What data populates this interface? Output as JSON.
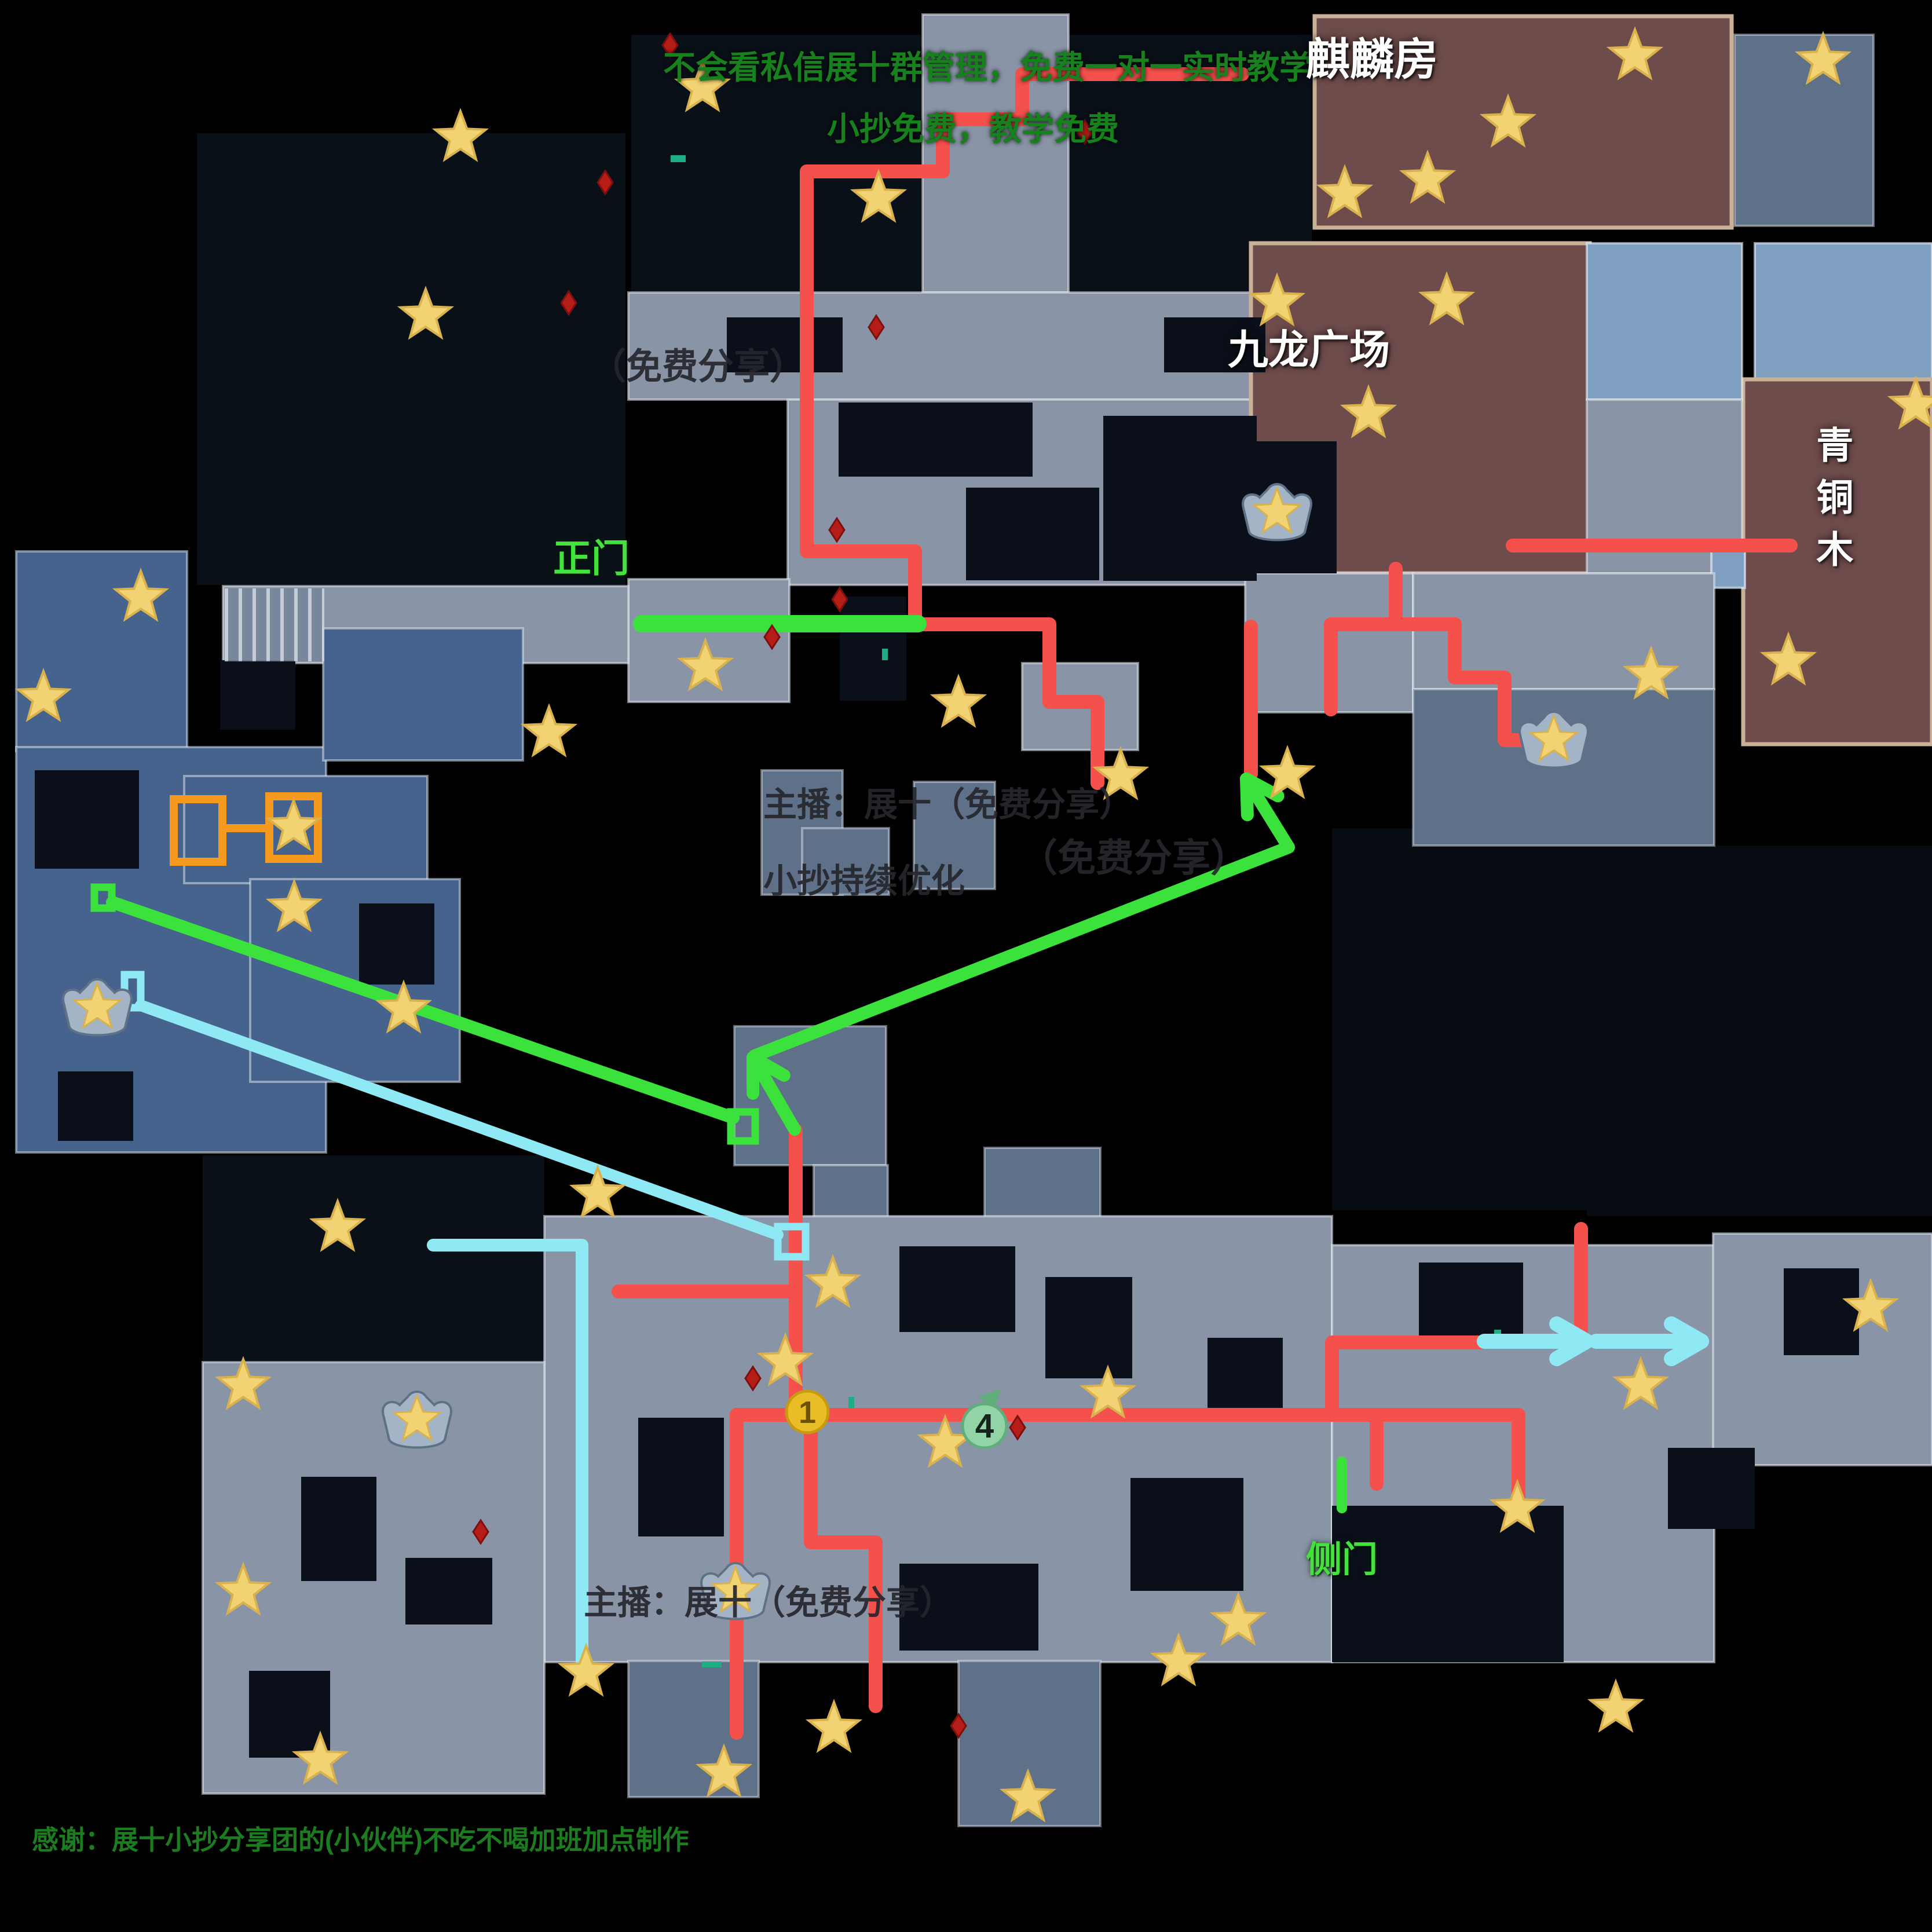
{
  "annotations": {
    "top_line1": "不会看私信展十群管理，免费一对一实时教学",
    "top_line2": "小抄免费，教学免费",
    "wm_share_top": "（免费分享）",
    "wm_host_mid": "主播：展十（免费分享）",
    "wm_optimize": "小抄持续优化",
    "wm_share_right": "（免费分享）",
    "wm_host_bottom": "主播：展十（免费分享）",
    "credit": "感谢：展十小抄分享团的(小伙伴)不吃不喝加班加点制作"
  },
  "labels": {
    "qilin_room": "麒麟房",
    "kowloon_plaza": "九龙广场",
    "bronze_wood": "青铜木",
    "main_gate": "正门",
    "side_gate": "侧门"
  },
  "markers": {
    "one": "1",
    "four": "4"
  },
  "colors": {
    "route_red": "#f4504c",
    "route_green": "#3ce23c",
    "route_cyan": "#8ee9f5",
    "orange": "#f59a1e",
    "teal": "#1fae84",
    "star_fill": "#f2d373",
    "star_edge": "#d9b24e",
    "hole": "#0a0f19",
    "item_fill": "#b51d18",
    "item_edge": "#7d0f0c",
    "rooms": {
      "g": {
        "fill": "#8994a6",
        "stroke": "rgba(228,233,240,0.55)",
        "sw": 4
      },
      "g2": {
        "fill": "#5f7089",
        "stroke": "rgba(228,233,240,0.45)",
        "sw": 4
      },
      "blue": {
        "fill": "#45638c",
        "stroke": "rgba(228,233,240,0.5)",
        "sw": 4
      },
      "pale": {
        "fill": "#7fa0c0",
        "stroke": "rgba(238,242,246,0.6)",
        "sw": 4
      },
      "brown": {
        "fill": "#6f4c4c",
        "stroke": "#c9b197",
        "sw": 7
      }
    }
  },
  "map": {
    "patches": [
      [
        340,
        230,
        740,
        780,
        "#0a1018"
      ],
      [
        1845,
        60,
        420,
        450,
        "#0a1018"
      ],
      [
        2300,
        1430,
        600,
        660,
        "#070c13"
      ],
      [
        350,
        1995,
        590,
        355,
        "#0a1018"
      ],
      [
        2740,
        1460,
        596,
        640,
        "#070c13"
      ],
      [
        1090,
        60,
        500,
        445,
        "#0a1018"
      ]
    ],
    "rooms": [
      [
        1593,
        25,
        252,
        480,
        "g"
      ],
      [
        1085,
        505,
        1185,
        185,
        "g"
      ],
      [
        1360,
        690,
        910,
        320,
        "g"
      ],
      [
        2160,
        420,
        585,
        570,
        "brown"
      ],
      [
        2270,
        28,
        720,
        365,
        "brown"
      ],
      [
        2995,
        60,
        240,
        330,
        "g2"
      ],
      [
        3030,
        420,
        306,
        235,
        "pale"
      ],
      [
        3010,
        655,
        326,
        630,
        "brown"
      ],
      [
        2740,
        420,
        268,
        270,
        "pale"
      ],
      [
        2740,
        690,
        268,
        300,
        "g"
      ],
      [
        2955,
        935,
        58,
        80,
        "pale"
      ],
      [
        2150,
        990,
        290,
        240,
        "g"
      ],
      [
        2440,
        990,
        520,
        200,
        "g"
      ],
      [
        2440,
        1190,
        520,
        270,
        "g2"
      ],
      [
        1085,
        1000,
        278,
        212,
        "g"
      ],
      [
        385,
        1012,
        700,
        133,
        "g"
      ],
      [
        1315,
        1330,
        140,
        215,
        "g2"
      ],
      [
        1385,
        1430,
        150,
        115,
        "g2"
      ],
      [
        1578,
        1350,
        140,
        185,
        "g2"
      ],
      [
        1268,
        1772,
        262,
        240,
        "g2"
      ],
      [
        1405,
        2012,
        128,
        150,
        "g2"
      ],
      [
        1700,
        1982,
        200,
        170,
        "g2"
      ],
      [
        1765,
        1145,
        200,
        150,
        "g"
      ],
      [
        28,
        952,
        295,
        345,
        "blue"
      ],
      [
        28,
        1290,
        535,
        700,
        "blue"
      ],
      [
        318,
        1340,
        420,
        185,
        "blue"
      ],
      [
        558,
        1085,
        345,
        228,
        "blue"
      ],
      [
        432,
        1518,
        362,
        350,
        "blue"
      ],
      [
        940,
        2100,
        1360,
        770,
        "g"
      ],
      [
        1655,
        2868,
        245,
        285,
        "g2"
      ],
      [
        1085,
        2868,
        225,
        235,
        "g2"
      ],
      [
        350,
        2352,
        590,
        745,
        "g"
      ],
      [
        2300,
        2150,
        660,
        720,
        "g"
      ],
      [
        2958,
        2130,
        378,
        400,
        "g"
      ]
    ],
    "holes": [
      [
        1448,
        695,
        335,
        128
      ],
      [
        1905,
        718,
        265,
        285
      ],
      [
        1668,
        842,
        230,
        160
      ],
      [
        1255,
        548,
        200,
        95
      ],
      [
        2010,
        548,
        175,
        95
      ],
      [
        1450,
        1030,
        115,
        180
      ],
      [
        2160,
        762,
        148,
        228
      ],
      [
        2450,
        2180,
        180,
        140
      ],
      [
        3080,
        2190,
        130,
        150
      ],
      [
        2880,
        2500,
        150,
        140
      ],
      [
        2300,
        2600,
        400,
        270
      ],
      [
        1553,
        2152,
        200,
        148
      ],
      [
        1805,
        2205,
        150,
        175
      ],
      [
        1102,
        2448,
        148,
        205
      ],
      [
        1553,
        2700,
        240,
        150
      ],
      [
        1952,
        2552,
        195,
        195
      ],
      [
        2085,
        2310,
        130,
        128
      ],
      [
        520,
        2550,
        130,
        180
      ],
      [
        700,
        2690,
        150,
        115
      ],
      [
        430,
        2885,
        140,
        150
      ],
      [
        60,
        1330,
        180,
        170
      ],
      [
        380,
        1140,
        130,
        120
      ],
      [
        620,
        1560,
        130,
        140
      ],
      [
        100,
        1850,
        130,
        120
      ]
    ],
    "routes_red": [
      [
        2145,
        128,
        1765,
        128,
        1765,
        206,
        1628,
        206,
        1628,
        296,
        1393,
        296,
        1393,
        952,
        1580,
        952,
        1580,
        1078,
        1812,
        1078,
        1812,
        1212,
        1895,
        1212,
        1895,
        1352
      ],
      [
        2410,
        982,
        2410,
        1078
      ],
      [
        2298,
        1078,
        2512,
        1078
      ],
      [
        2298,
        1078,
        2298,
        1225
      ],
      [
        2512,
        1078,
        2512,
        1170,
        2598,
        1170,
        2598,
        1278,
        2652,
        1278
      ],
      [
        2160,
        1082,
        2160,
        1336
      ],
      [
        2612,
        942,
        3092,
        942
      ],
      [
        1374,
        1952,
        1374,
        2443
      ],
      [
        1068,
        2230,
        1374,
        2230
      ],
      [
        1272,
        2443,
        2622,
        2443
      ],
      [
        1272,
        2443,
        1272,
        2992
      ],
      [
        1400,
        2443,
        1400,
        2663,
        1512,
        2663,
        1512,
        2946
      ],
      [
        2300,
        2443,
        2300,
        2318,
        2558,
        2318
      ],
      [
        2377,
        2443,
        2377,
        2562
      ],
      [
        2622,
        2443,
        2622,
        2600
      ],
      [
        2730,
        2122,
        2730,
        2314
      ]
    ],
    "routes_green": [
      {
        "pts": [
          1108,
          1077,
          1585,
          1077
        ],
        "w": 30
      },
      {
        "pts": [
          194,
          1558,
          1266,
          1930
        ],
        "w": 22
      }
    ],
    "green_arrows": [
      {
        "pts": [
          1303,
          1823,
          2225,
          1463,
          2152,
          1345
        ],
        "w": 22
      },
      {
        "pts": [
          1372,
          1950,
          1300,
          1826
        ],
        "w": 22
      }
    ],
    "routes_cyan": [
      {
        "pts": [
          748,
          2150,
          1005,
          2150,
          1005,
          2878
        ],
        "w": 22
      },
      {
        "pts": [
          243,
          1736,
          1343,
          2132
        ],
        "w": 20
      }
    ],
    "cyan_arrows": [
      {
        "pts": [
          2563,
          2316,
          2740,
          2316
        ],
        "w": 26
      },
      {
        "pts": [
          2756,
          2316,
          2938,
          2316
        ],
        "w": 26
      }
    ],
    "door_green": [
      2317,
      2524,
      2317,
      2604
    ],
    "orange_rects": [
      [
        300,
        1380,
        84,
        108
      ],
      [
        465,
        1375,
        84,
        108
      ]
    ],
    "orange_line": [
      384,
      1430,
      465,
      1430
    ],
    "green_squares": [
      [
        163,
        1532,
        30,
        36
      ],
      [
        1262,
        1920,
        42,
        50
      ]
    ],
    "cyan_rects": [
      [
        215,
        1683,
        28,
        57
      ],
      [
        1343,
        2118,
        48,
        52
      ]
    ],
    "teal_marks": [
      [
        1158,
        268,
        26,
        12
      ],
      [
        1465,
        2412,
        10,
        22
      ],
      [
        1212,
        2869,
        34,
        10
      ],
      [
        2580,
        2296,
        12,
        20
      ],
      [
        1523,
        1120,
        10,
        20
      ]
    ],
    "items": [
      [
        1157,
        78
      ],
      [
        1045,
        315
      ],
      [
        982,
        523
      ],
      [
        1873,
        228
      ],
      [
        1513,
        565
      ],
      [
        1445,
        915
      ],
      [
        1450,
        1035
      ],
      [
        1333,
        1100
      ],
      [
        1300,
        2380
      ],
      [
        1757,
        2465
      ],
      [
        830,
        2645
      ],
      [
        1655,
        2980
      ]
    ],
    "shrines": [
      [
        2205,
        885
      ],
      [
        2683,
        1278
      ],
      [
        168,
        1740
      ],
      [
        1270,
        2748
      ],
      [
        720,
        2452
      ]
    ],
    "stars": [
      [
        1213,
        152
      ],
      [
        795,
        238
      ],
      [
        1517,
        343
      ],
      [
        735,
        545
      ],
      [
        2604,
        213
      ],
      [
        2823,
        97
      ],
      [
        3148,
        105
      ],
      [
        2322,
        335
      ],
      [
        2465,
        310
      ],
      [
        2205,
        522
      ],
      [
        2498,
        520
      ],
      [
        2363,
        715
      ],
      [
        3308,
        700
      ],
      [
        3088,
        1142
      ],
      [
        2851,
        1166
      ],
      [
        243,
        1032
      ],
      [
        75,
        1205
      ],
      [
        1218,
        1152
      ],
      [
        948,
        1266
      ],
      [
        507,
        1428
      ],
      [
        508,
        1568
      ],
      [
        697,
        1743
      ],
      [
        1655,
        1215
      ],
      [
        1935,
        1340
      ],
      [
        2223,
        1338
      ],
      [
        1032,
        2062
      ],
      [
        583,
        2120
      ],
      [
        1438,
        2217
      ],
      [
        1356,
        2352
      ],
      [
        420,
        2393
      ],
      [
        1632,
        2493
      ],
      [
        1913,
        2408
      ],
      [
        2620,
        2605
      ],
      [
        2138,
        2800
      ],
      [
        2833,
        2393
      ],
      [
        3230,
        2258
      ],
      [
        2790,
        2950
      ],
      [
        420,
        2748
      ],
      [
        553,
        3040
      ],
      [
        1012,
        2888
      ],
      [
        1440,
        2985
      ],
      [
        1250,
        3062
      ],
      [
        1775,
        3105
      ],
      [
        2035,
        2870
      ]
    ],
    "marker_one_pos": [
      1394,
      2438
    ],
    "marker_four_pos": [
      1700,
      2462
    ]
  }
}
